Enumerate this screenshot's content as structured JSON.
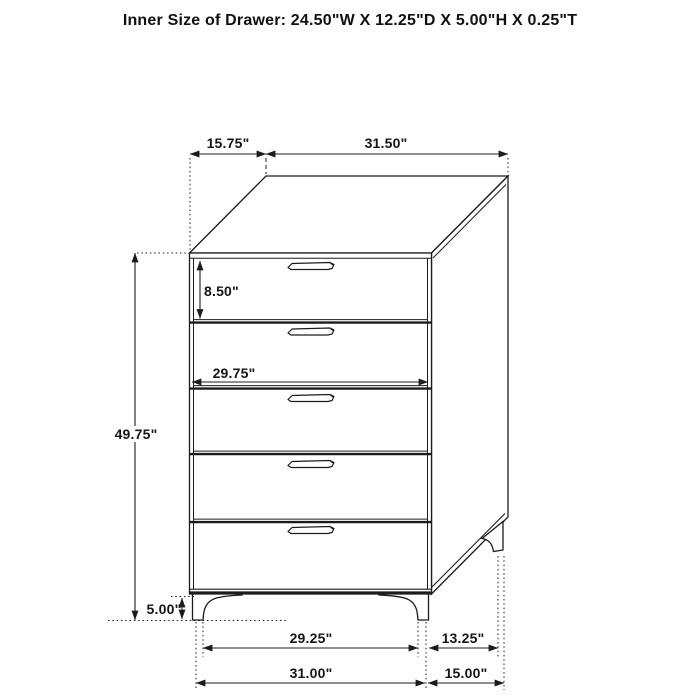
{
  "title": "Inner Size of Drawer: 24.50\"W X 12.25\"D X 5.00\"H X 0.25\"T",
  "diagram": {
    "subject": "five-drawer chest line drawing with dimension callouts",
    "line_color": "#1c1c1c",
    "background_color": "#ffffff",
    "drawer_count": 5
  },
  "dims": {
    "top_depth": "15.75\"",
    "top_width": "31.50\"",
    "top_drawer_height": "8.50\"",
    "drawer_front_width": "29.75\"",
    "overall_height": "49.75\"",
    "leg_height": "5.00\"",
    "front_leg_span": "29.25\"",
    "side_leg_span": "13.25\"",
    "base_front_width": "31.00\"",
    "base_side_depth": "15.00\""
  }
}
